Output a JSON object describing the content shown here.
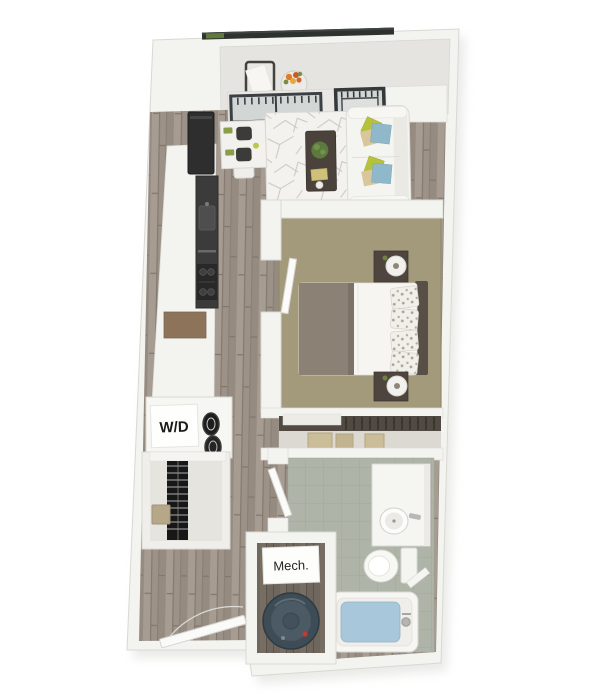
{
  "image": {
    "kind": "3d-floorplan-render",
    "background": "#ffffff"
  },
  "labels": {
    "washer_dryer": "W/D",
    "mechanical": "Mech."
  },
  "colors": {
    "wall": "#f3f3f0",
    "wall_stroke": "#d9d8d3",
    "wood_floor": "#9c9288",
    "wood_floor_dark": "#6f665d",
    "bedroom_carpet": "#a39a7c",
    "bathroom_tile": "#aeb4a8",
    "tub_water": "#a9c7da",
    "rug_base": "#f3f2ee",
    "appliance_dark": "#3b3b3b",
    "refrigerator_dark": "#2e2e2e",
    "cabinet_brown": "#8d7359",
    "sofa": "#f4f4f1",
    "pillow_blue": "#8fb8ca",
    "pillow_green": "#b6c23c",
    "pillow_tan": "#d8c69c",
    "bed_blanket": "#8b8175",
    "headboard": "#584f47",
    "nightstand": "#4e453e",
    "water_heater": "#3e4c56",
    "railing": "#2e322f",
    "plant_green": "#5d7a3d",
    "flower_orange": "#dd7c2e",
    "closet_clothes": "#171717",
    "basket_tan": "#cbbd98"
  }
}
